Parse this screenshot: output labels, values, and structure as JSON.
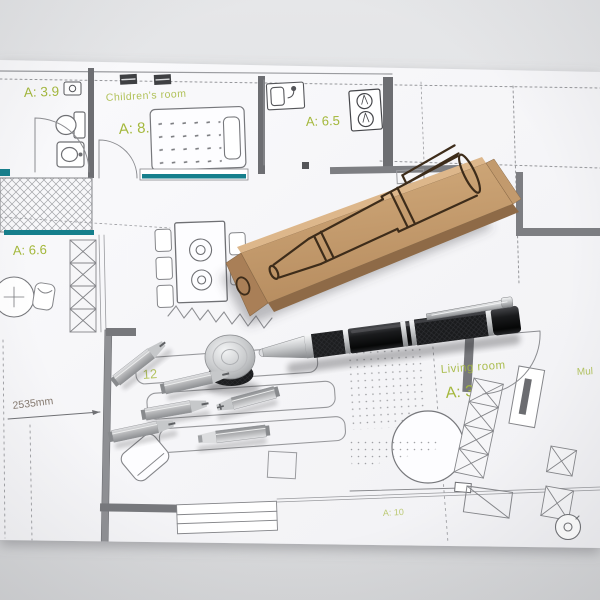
{
  "photo": {
    "background_color": "#e2e3e5",
    "paper_color": "#f8f9fb"
  },
  "floor_plan": {
    "label_color": "#a4b83c",
    "window_color": "#157f8c",
    "labels": {
      "bath_area": "A: 3.9",
      "childrens_room_name": "Children's room",
      "childrens_room_area": "A: 8.3",
      "kitchen_area": "A: 6.5",
      "hall_area": "A: 6.6",
      "living_room_name": "Living room",
      "living_room_area": "A: 39.5",
      "bedroom_area": "A: 10",
      "corner_number": "12",
      "dimension": "2535mm",
      "right_edge_partial": "Mul"
    }
  },
  "objects": {
    "box_color": "#c49a6c",
    "pen_body_color": "#141517",
    "metal_color": "#c9cbcd",
    "bit_count": 6
  }
}
